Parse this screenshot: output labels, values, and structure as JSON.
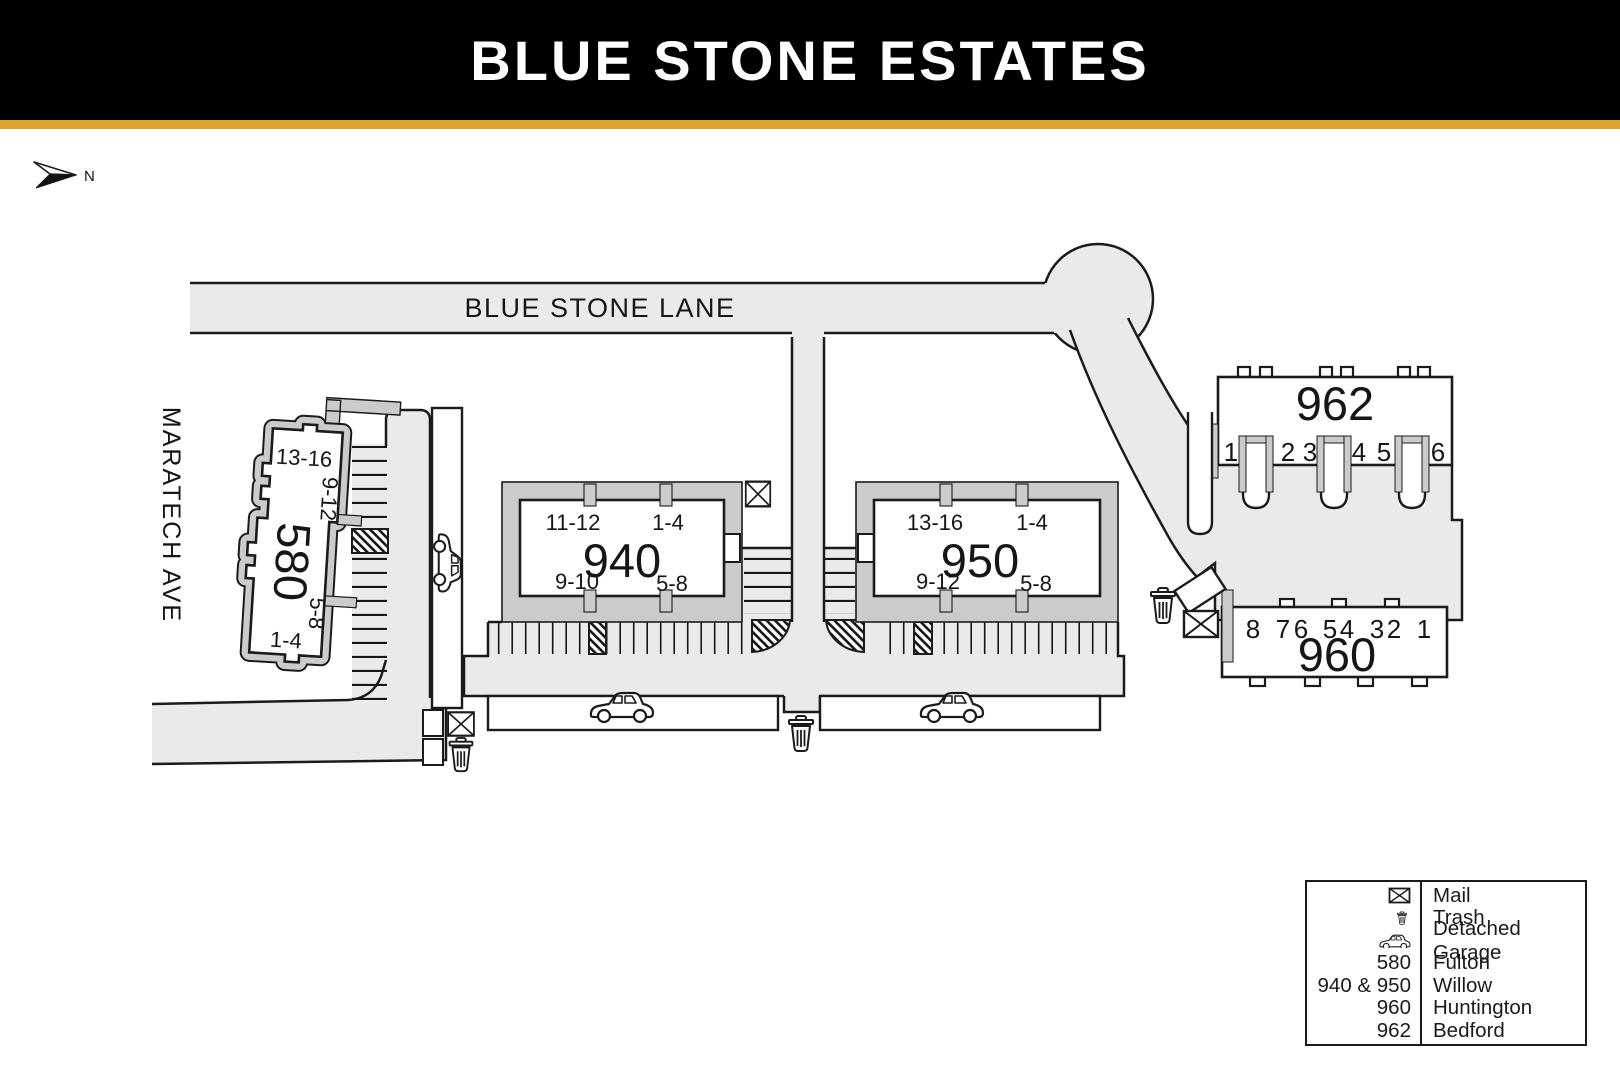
{
  "header": {
    "title": "BLUE STONE ESTATES"
  },
  "compass": {
    "north_label": "N"
  },
  "roads": {
    "lane_label": "BLUE STONE LANE",
    "ave_label": "MARATECH AVE"
  },
  "buildings": {
    "b580": {
      "number": "580",
      "unit_top": "13-16",
      "unit_upper_mid": "9-12",
      "unit_lower_mid": "5-8",
      "unit_bottom": "1-4"
    },
    "b940": {
      "number": "940",
      "unit_tl": "11-12",
      "unit_tr": "1-4",
      "unit_bl": "9-10",
      "unit_br": "5-8"
    },
    "b950": {
      "number": "950",
      "unit_tl": "13-16",
      "unit_tr": "1-4",
      "unit_bl": "9-12",
      "unit_br": "5-8"
    },
    "b962": {
      "number": "962",
      "units": [
        "1",
        "2",
        "3",
        "4",
        "5",
        "6"
      ]
    },
    "b960": {
      "number": "960",
      "units": [
        "8",
        "7",
        "6",
        "5",
        "4",
        "3",
        "2",
        "1"
      ]
    }
  },
  "legend": {
    "rows": [
      {
        "icon": "mail-icon",
        "label": "Mail"
      },
      {
        "icon": "trash-icon",
        "label": "Trash"
      },
      {
        "icon": "car-icon",
        "label": "Detached Garage"
      },
      {
        "key": "580",
        "label": "Fulton"
      },
      {
        "key": "940 & 950",
        "label": "Willow"
      },
      {
        "key": "960",
        "label": "Huntington"
      },
      {
        "key": "962",
        "label": "Bedford"
      }
    ]
  },
  "colors": {
    "header_bg": "#000000",
    "accent_gold": "#DFA32F",
    "road_fill": "#E9EAEC",
    "walkway_fill": "#C9CBCD",
    "outline": "#1B1B1B"
  }
}
